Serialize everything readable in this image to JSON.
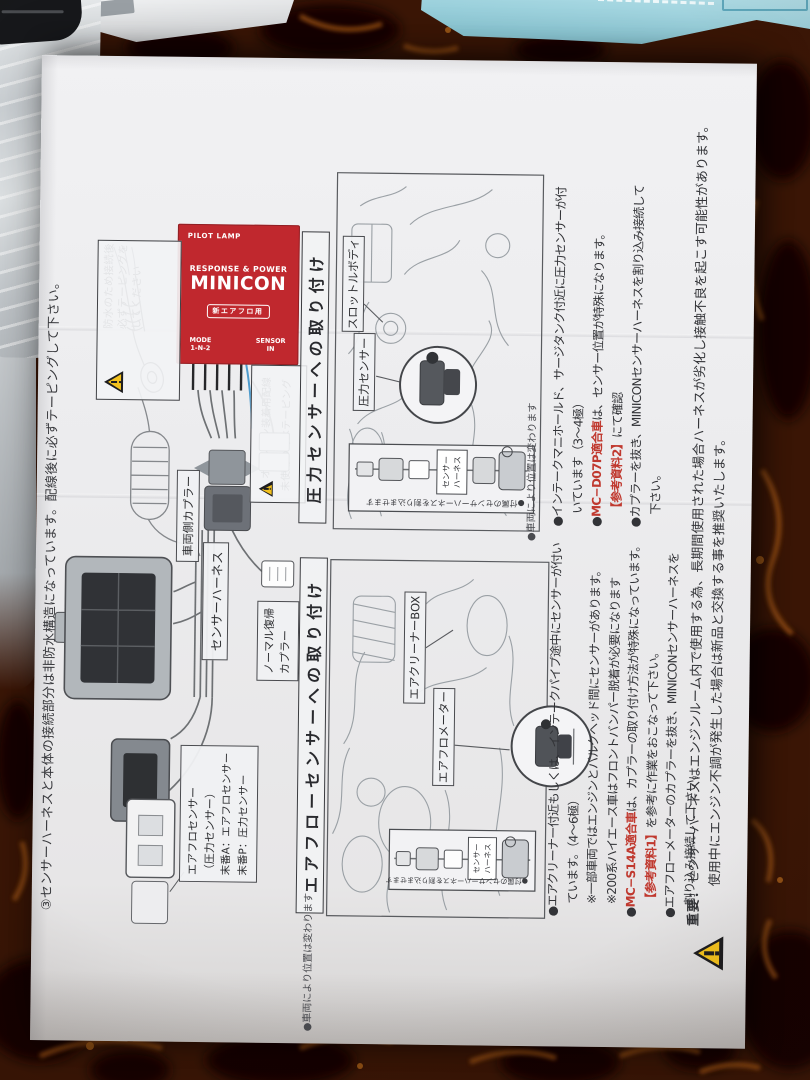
{
  "colors": {
    "device_red": "#c0282e",
    "table_brown": "#3b1606",
    "folder_blue": "#9fd4e0",
    "accent_red": "#c0392f",
    "warning_yellow": "#f2c11d"
  },
  "page": {
    "top_note": "③センサーハーネスと本体の接続部分は非防水構造になっています。配線後に必ずテーピングして下さい。",
    "device": {
      "pilot_lamp": "PILOT LAMP",
      "tagline": "RESPONSE & POWER",
      "name": "MINICON",
      "badge": "新エアフロ用",
      "mode": "MODE",
      "mode_positions": "1-N-2",
      "sensor": "SENSOR",
      "sensor_in": "IN"
    },
    "wiring": {
      "vehicle_coupler": "車両側カプラー",
      "sensor_harness": "センサーハーネス",
      "normal_return_1": "ノーマル復帰",
      "normal_return_2": "カプラー",
      "airflow_label_1": "エアフロセンサー",
      "airflow_label_2": "（圧力センサー）",
      "airflow_label_3": "末番A：エアフロセンサー",
      "airflow_label_4": "末番P：圧力センサー",
      "waterproof_1": "防水のため接続後",
      "waterproof_2": "必ずテーピングを",
      "waterproof_3": "してください",
      "option_1": "オプション装着用配線",
      "option_2": "未使用の時はテーピング"
    },
    "pressure_section": {
      "title": "圧力センサーへの取り付け",
      "label_throttle": "スロットルボディ",
      "label_sensor": "圧力センサー",
      "position_note": "●車両により位置は変わります",
      "inset_caption": "●付属のセンサーハーネスを割り込ませます",
      "inset_label_1": "センサー",
      "inset_label_2": "ハーネス",
      "b1a": "●インテークマニホールド、サージタンク付近に圧力センサーが付",
      "b1b": "いています（3～4極）",
      "b2a": "●",
      "b2b": "MC−D07P適合車",
      "b2c": "は、センサー位置が特殊になります。",
      "b3a": "【参考資料2】",
      "b3b": "にて確認",
      "b4a": "●カプラーを抜き、MINICONセンサーハーネスを割り込み接続して",
      "b4b": "下さい。"
    },
    "airflow_section": {
      "title": "エアフローセンサーへの取り付け",
      "label_cleaner": "エアクリーナーBOX",
      "label_meter": "エアフロメーター",
      "position_note": "●車両により位置は変わります",
      "inset_caption": "●付属のセンサーハーネスを割り込ませます",
      "inset_label_1": "センサー",
      "inset_label_2": "ハーネス",
      "b1a": "●エアクリーナー付近もしくは、インテークパイプ途中にセンサーが付い",
      "b1b": "ています。（4～6極）",
      "b2": "※一部車両ではエンジンとバルクヘッド間にセンサーがあります。",
      "b3": "※200系ハイエース車はフロントバンパー脱着が必要になります",
      "b4a": "●",
      "b4b": "MC−S14A適合車",
      "b4c": "は、カプラーの取り付け方法が特殊になっています。",
      "b5a": "【参考資料1】",
      "b5b": "を参考に作業をおこなって下さい。",
      "b6a": "●エアフローメーターのカプラーを抜き、MINICONセンサーハーネスを",
      "b6b": "割り込み接続して下さい。"
    },
    "important": {
      "label": "重要：",
      "line1": "センサーハーネスはエンジンルーム内で使用する為、長期間使用された場合ハーネスが劣化し接触不良を起こす可能性があります。",
      "line2": "使用中にエンジン不調が発生した場合は新品と交換する事を推奨いたします。"
    }
  }
}
